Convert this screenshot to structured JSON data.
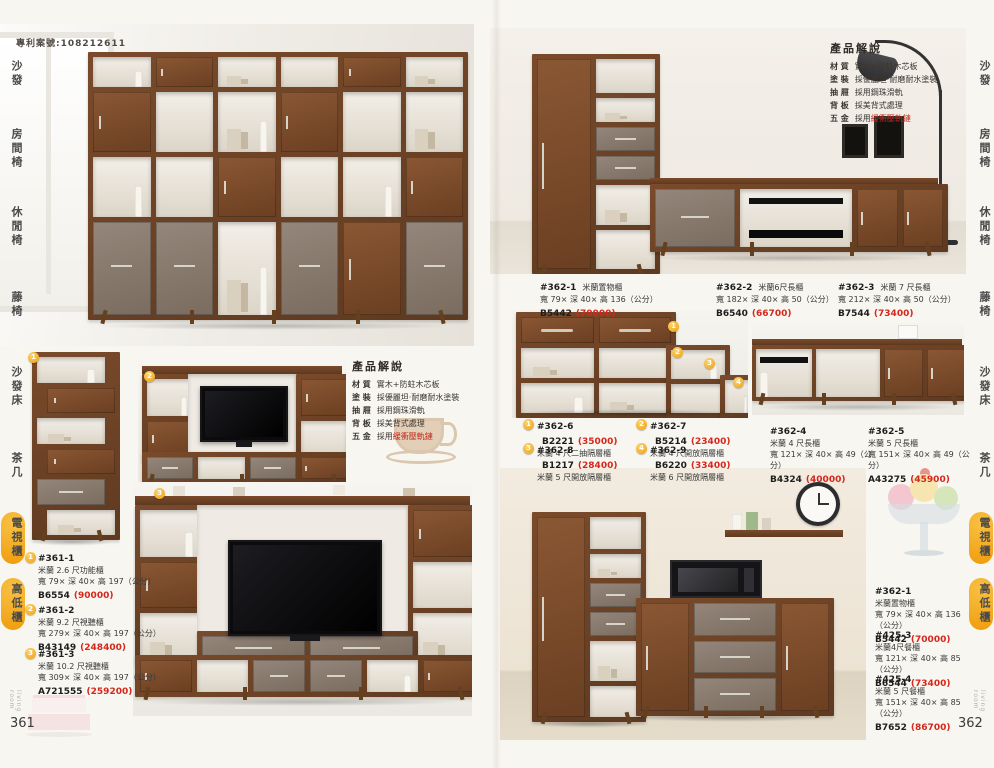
{
  "patent_number": "專利案號:108212611",
  "side_label": "living room",
  "sidebar_items": [
    "沙發",
    "房間椅",
    "休閒椅",
    "藤椅",
    "沙發床",
    "茶几",
    "電視櫃",
    "高低櫃"
  ],
  "description": {
    "title": "產品解說",
    "lines": [
      {
        "label": "材 質",
        "text": "實木+防蛀木芯板",
        "red": ""
      },
      {
        "label": "塗 裝",
        "text": "採優麗坦·耐磨耐水塗裝",
        "red": ""
      },
      {
        "label": "抽 屜",
        "text": "採用鋼珠滑軌",
        "red": ""
      },
      {
        "label": "背 板",
        "text": "採美背式處理",
        "red": ""
      },
      {
        "label": "五 金",
        "text": "採用",
        "red": "緩衝壓軌鏈"
      }
    ]
  },
  "page_left": {
    "number": "361",
    "products": [
      {
        "num": "1",
        "code": "#361-1",
        "name": "米蘭 2.6 尺功能櫃",
        "dims": "寬 79× 深 40× 高 197（公分）",
        "model": "B6554",
        "price": "(90000)"
      },
      {
        "num": "2",
        "code": "#361-2",
        "name": "米蘭 9.2 尺視聽櫃",
        "dims": "寬 279× 深 40× 高 197（公分）",
        "model": "B43149",
        "price": "(248400)"
      },
      {
        "num": "3",
        "code": "#361-3",
        "name": "米蘭 10.2 尺視聽櫃",
        "dims": "寬 309× 深 40× 高 197（公分）",
        "model": "A721555",
        "price": "(259200)"
      }
    ]
  },
  "page_right": {
    "number": "362",
    "row_products": [
      {
        "code": "#362-1",
        "name": "米蘭置物櫃",
        "dims": "寬 79× 深 40× 高 136（公分）",
        "model": "B5442",
        "price": "(70000)"
      },
      {
        "code": "#362-2",
        "name": "米蘭6尺長櫃",
        "dims": "寬 182× 深 40× 高 50（公分）",
        "model": "B6540",
        "price": "(66700)"
      },
      {
        "code": "#362-3",
        "name": "米蘭 7 尺長櫃",
        "dims": "寬 212× 深 40× 高 50（公分）",
        "model": "B7544",
        "price": "(73400)"
      }
    ],
    "step_products": [
      {
        "num": "1",
        "code": "#362-6",
        "model": "B2221",
        "price": "(35000)",
        "name": "米蘭 4 尺二抽隔層櫃"
      },
      {
        "num": "3",
        "code": "#362-8",
        "model": "B1217",
        "price": "(28400)",
        "name": "米蘭 5 尺開放隔層櫃"
      },
      {
        "num": "2",
        "code": "#362-7",
        "model": "B5214",
        "price": "(23400)",
        "name": "米蘭 4 尺開放隔層櫃"
      },
      {
        "num": "4",
        "code": "#362-9",
        "model": "B6220",
        "price": "(33400)",
        "name": "米蘭 6 尺開放隔層櫃"
      }
    ],
    "long_products": [
      {
        "code": "#362-4",
        "name": "米蘭 4 尺長櫃",
        "dims": "寬 121× 深 40× 高 49（公分）",
        "model": "B4324",
        "price": "(40000)"
      },
      {
        "code": "#362-5",
        "name": "米蘭 5 尺長櫃",
        "dims": "寬 151× 深 40× 高 49（公分）",
        "model": "A43275",
        "price": "(45900)"
      }
    ],
    "side_products": [
      {
        "code": "#362-1",
        "name": "米蘭置物櫃",
        "dims": "寬 79× 深 40× 高 136（公分）",
        "model": "B5442",
        "price": "(70000)"
      },
      {
        "code": "#425-3",
        "name": "米蘭4尺餐櫃",
        "dims": "寬 121× 深 40× 高 85（公分）",
        "model": "B6544",
        "price": "(73400)"
      },
      {
        "code": "#425-4",
        "name": "米蘭 5 尺餐櫃",
        "dims": "寬 151× 深 40× 高 85（公分）",
        "model": "B7652",
        "price": "(86700)"
      }
    ]
  },
  "colors": {
    "accent_yellow": "#f2a818",
    "price_red": "#d6271c",
    "walnut": "#74452a",
    "taupe": "#8e7e6f"
  }
}
